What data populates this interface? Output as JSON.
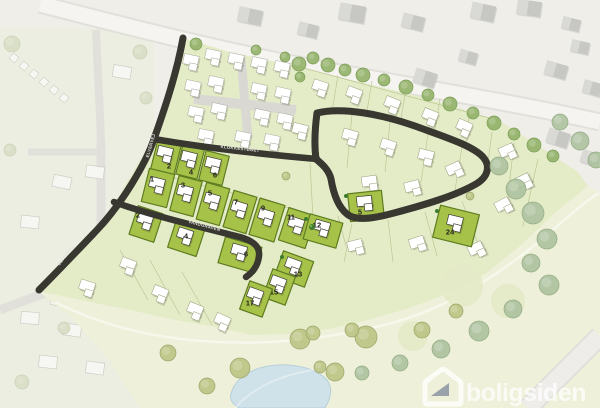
{
  "map": {
    "title": "residential site plan",
    "watermark": {
      "text": "boligsiden"
    },
    "streets": [
      {
        "name": "KLOKKESTØBET",
        "x": 240,
        "y": 150,
        "rotate": 6
      },
      {
        "name": "VANDGRAVEN",
        "x": 204,
        "y": 227,
        "rotate": 15
      },
      {
        "name": "ELVERVEJ",
        "x": 152,
        "y": 146,
        "rotate": -74
      },
      {
        "name": "ELVERVEJ",
        "x": 67,
        "y": 256,
        "rotate": -52
      }
    ],
    "plots": [
      {
        "number": "2",
        "cx": 166,
        "cy": 157,
        "w": 24,
        "h": 30,
        "deg": 14,
        "lx": 169,
        "ly": 166
      },
      {
        "number": "4",
        "cx": 190,
        "cy": 162,
        "w": 22,
        "h": 30,
        "deg": 14,
        "lx": 191,
        "ly": 172
      },
      {
        "number": "6",
        "cx": 214,
        "cy": 168,
        "w": 24,
        "h": 30,
        "deg": 14,
        "lx": 215,
        "ly": 175
      },
      {
        "number": "1",
        "cx": 158,
        "cy": 188,
        "w": 26,
        "h": 34,
        "deg": 14,
        "lx": 152,
        "ly": 179
      },
      {
        "number": "3",
        "cx": 186,
        "cy": 196,
        "w": 24,
        "h": 36,
        "deg": 15,
        "lx": 183,
        "ly": 185
      },
      {
        "number": "5",
        "cx": 213,
        "cy": 204,
        "w": 24,
        "h": 38,
        "deg": 16,
        "lx": 210,
        "ly": 193
      },
      {
        "number": "7",
        "cx": 240,
        "cy": 212,
        "w": 24,
        "h": 38,
        "deg": 17,
        "lx": 236,
        "ly": 202
      },
      {
        "number": "9",
        "cx": 267,
        "cy": 220,
        "w": 26,
        "h": 38,
        "deg": 17,
        "lx": 263,
        "ly": 208
      },
      {
        "number": "11",
        "cx": 297,
        "cy": 228,
        "w": 28,
        "h": 34,
        "deg": 18,
        "lx": 291,
        "ly": 217
      },
      {
        "number": "12",
        "cx": 323,
        "cy": 231,
        "w": 34,
        "h": 26,
        "deg": 16,
        "lx": 317,
        "ly": 225
      },
      {
        "number": "2",
        "cx": 146,
        "cy": 224,
        "w": 26,
        "h": 30,
        "deg": 18,
        "lx": 138,
        "ly": 215
      },
      {
        "number": "4",
        "cx": 186,
        "cy": 239,
        "w": 30,
        "h": 27,
        "deg": 18,
        "lx": 186,
        "ly": 236
      },
      {
        "number": "6",
        "cx": 240,
        "cy": 255,
        "w": 38,
        "h": 27,
        "deg": 16,
        "lx": 246,
        "ly": 254
      },
      {
        "number": "13",
        "cx": 294,
        "cy": 269,
        "w": 32,
        "h": 27,
        "deg": 20,
        "lx": 298,
        "ly": 274
      },
      {
        "number": "15",
        "cx": 279,
        "cy": 287,
        "w": 24,
        "h": 30,
        "deg": 20,
        "lx": 274,
        "ly": 292
      },
      {
        "number": "17",
        "cx": 256,
        "cy": 299,
        "w": 24,
        "h": 30,
        "deg": 20,
        "lx": 250,
        "ly": 303
      },
      {
        "number": "5",
        "cx": 366,
        "cy": 206,
        "w": 34,
        "h": 28,
        "deg": -6,
        "lx": 360,
        "ly": 212
      },
      {
        "number": "24",
        "cx": 456,
        "cy": 226,
        "w": 40,
        "h": 33,
        "deg": 14,
        "lx": 450,
        "ly": 232
      }
    ],
    "colors": {
      "available_plot": "#a6c248",
      "plot_border": "#5e7c20",
      "new_road": "#383730",
      "site_area": "#e4ecc7",
      "open_space": "#eef0d9",
      "pond": "#cfe2e9",
      "existing_buildings": "#c7c7c4"
    }
  }
}
